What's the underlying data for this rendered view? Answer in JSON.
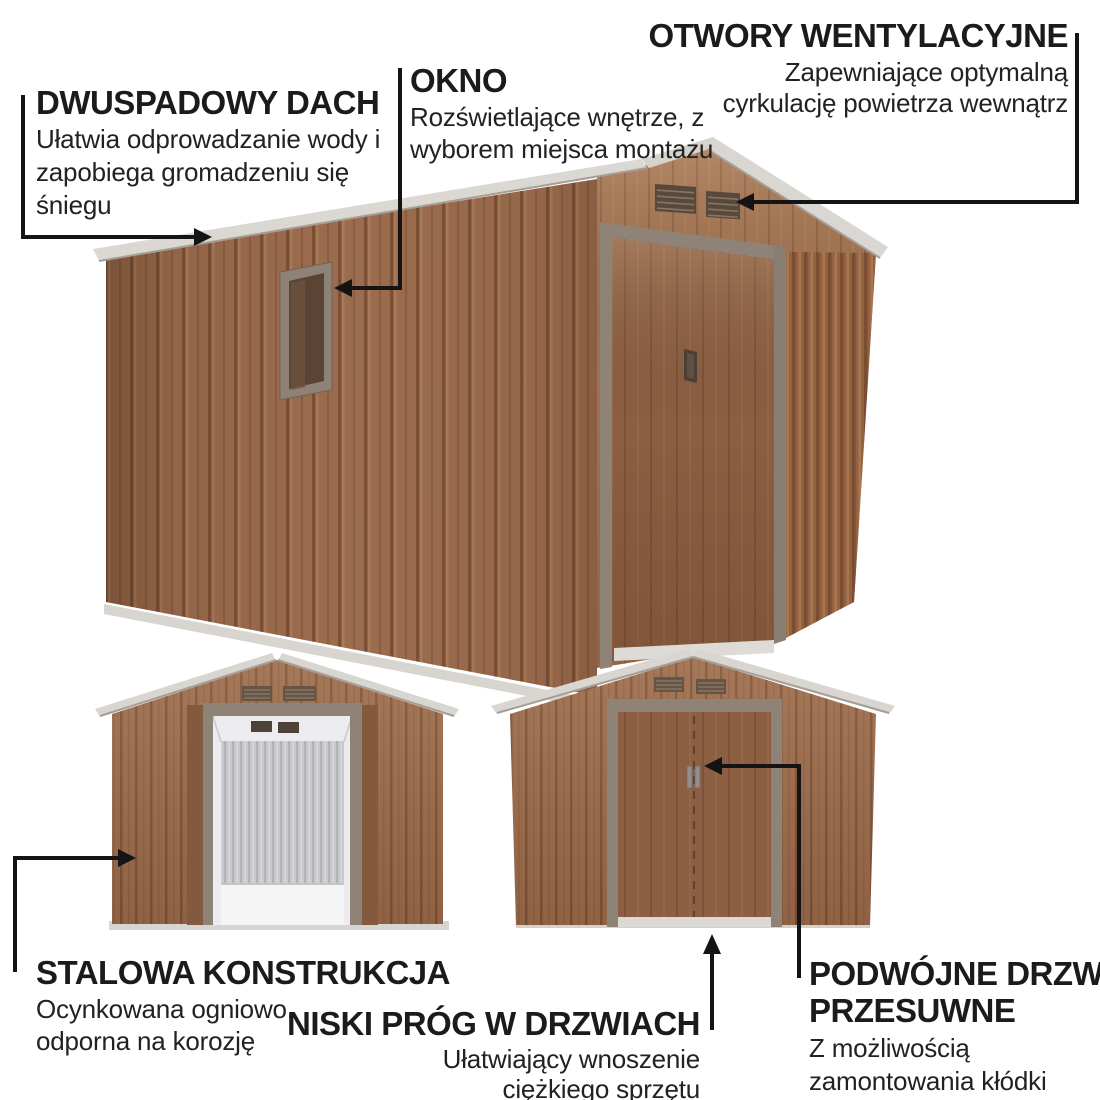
{
  "callouts": {
    "roof": {
      "title": "DWUSPADOWY DACH",
      "lines": [
        "Ułatwia odprowadzanie wody i",
        "zapobiega gromadzeniu się",
        "śniegu"
      ]
    },
    "window": {
      "title": "OKNO",
      "lines": [
        "Rozświetlające wnętrze, z",
        "wyborem miejsca montażu"
      ]
    },
    "vents": {
      "title": "OTWORY WENTYLACYJNE",
      "lines": [
        "Zapewniające optymalną",
        "cyrkulację powietrza wewnątrz"
      ]
    },
    "steel": {
      "title": "STALOWA KONSTRUKCJA",
      "lines": [
        "Ocynkowana ogniowo,",
        "odporna na korozję"
      ]
    },
    "threshold": {
      "title": "NISKI PRÓG W DRZWIACH",
      "lines": [
        "Ułatwiający wnoszenie",
        "ciężkiego sprzętu"
      ]
    },
    "doors": {
      "title_lines": [
        "PODWÓJNE DRZWI",
        "PRZESUWNE"
      ],
      "lines": [
        "Z możliwością",
        "zamontowania kłódki"
      ]
    }
  },
  "colors": {
    "background": "#ffffff",
    "text": "#1b1b1b",
    "callout_line": "#141414",
    "wall_brown": "#9c6c4e",
    "door_brown": "#8d5f42",
    "frame_taupe": "#8f8277",
    "roof_trim": "#d9d6d1",
    "interior_gray": "#c8c8cc",
    "vent_dark": "#57493c",
    "base_gray": "#d8d5d0"
  }
}
